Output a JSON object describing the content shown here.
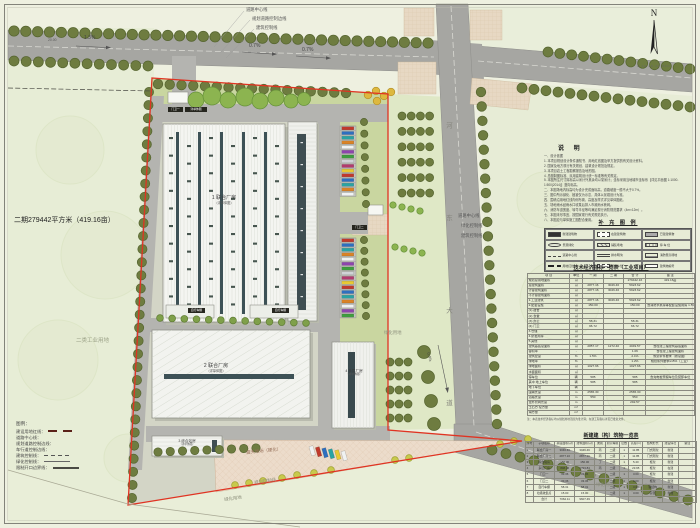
{
  "colors": {
    "paper": "#eef0e0",
    "road": "#a6a6a2",
    "inner_road": "#b4b4b0",
    "green_strip": "#c9d6a0",
    "outside_green": "#e7edd6",
    "tree": "#6e7c40",
    "bright_tree": "#8cb450",
    "boundary_red": "#e03322",
    "building_white": "#f4f5f1",
    "skylight_dark": "#3d5156",
    "plaza": "#ecdccb",
    "pad": "#e7d8c3"
  },
  "plan": {
    "boundary_area_label": "二期279442平方米（419.16亩）",
    "land_use_label": "二类工业用地",
    "top_line_labels": [
      "道路中心线",
      "规划道路控制边线",
      "建筑控制线"
    ],
    "right_line_labels": [
      "道路中心线",
      "绿化控制线",
      "建筑控制线"
    ],
    "slopes": {
      "s1": "1.3%",
      "s2": "0.7%",
      "s3": "0.7%",
      "s4": "0.4%"
    },
    "road_width_label": "20.00",
    "vertical_road_name": "河东大道",
    "buildings": [
      {
        "label": "1 联合厂房",
        "sub": "（详单体图）"
      },
      {
        "label": "2 联合厂房",
        "sub": "（详单体图）"
      },
      {
        "label": "3 综合站房",
        "sub": "（详单体图）"
      },
      {
        "label": "4 多层厂房",
        "sub": "（详单体图）"
      }
    ],
    "shed_label": "自行车棚",
    "gate1_label": "门卫一",
    "gate1_sub": "详单体图",
    "gate2_label": "门卫二",
    "plaza_label": "露天堆场（硬化）",
    "green_label": "绿化用地",
    "control_label": "规划控制线",
    "legend": {
      "title": "图例：",
      "items": [
        {
          "label": "建设用地红线：",
          "sample": "redash"
        },
        {
          "label": "道路中心线：",
          "sample": "none"
        },
        {
          "label": "规划道路控制边线：",
          "sample": "none"
        },
        {
          "label": "车行道控制边线：",
          "sample": "none"
        },
        {
          "label": "建筑控制线：",
          "sample": "dash"
        },
        {
          "label": "绿化控制线：",
          "sample": "solid"
        },
        {
          "label": "限制开口边界线：",
          "sample": "thick"
        }
      ]
    }
  },
  "panel": {
    "north": {
      "label": "N",
      "scale": "0  10  20  40  80m"
    },
    "notes": {
      "title": "说  明",
      "lines": [
        "一、设计依据",
        "1. 本项目规划设计条件通知书、用地红线图及甲方提供的有关设计资料。",
        "2. 国家及地方现行有关规划、建筑设计规范及规定。",
        "3. 本项目岩土工程勘察报告及地形图。",
        "4. 总图制图标准、民用建筑设计统一标准等有关规定。",
        "5. 本图所注尺寸除标高以米计外其余均以毫米计；坐标采用当地城市坐标系【详见平面图 1:1000-1:500(2014)】竖向标高。",
        "二、本图场地内标高均为设计完成面标高，道路坡度一般不大于0.7%。",
        "三、图中所示绿化、植被仅为示意，具体以景观设计为准。",
        "四、围墙沿用地红线内侧布置，高度及样式详见单体图纸。",
        "五、场地雨水经雨水口收集后排入市政雨水管网。",
        "六、消防车道宽度、转弯半径等均满足现行消防规范要求（4m×12m）。",
        "七、本图未尽事宜，按国家现行有关规范执行。",
        "八、本图应与单体施工图配合使用。"
      ]
    },
    "sup_legend": {
      "title": "补 充 图 例",
      "items": [
        {
          "sym": "solid",
          "label": "新建建筑物"
        },
        {
          "sym": "dash",
          "label": "在建建筑物"
        },
        {
          "sym": "gray",
          "label": "已建建筑物"
        },
        {
          "sym": "blob",
          "label": "景观绿化"
        },
        {
          "sym": "hatch",
          "label": "铺装场地"
        },
        {
          "sym": "vlines",
          "label": "停 车 位"
        },
        {
          "sym": "dashdot",
          "label": "道路中心线"
        },
        {
          "sym": "double",
          "label": "排水明沟"
        },
        {
          "sym": "ticks",
          "label": "消防登高场地"
        },
        {
          "sym": "bolddash",
          "label": "用地红线"
        },
        {
          "sym": "dash",
          "label": "机动车位"
        },
        {
          "sym": "open",
          "label": "建筑物编号"
        }
      ]
    },
    "table1": {
      "title": "技术经济指标一览表（工业项目）",
      "headers": [
        "项  目",
        "单位",
        "一 期",
        "二 期",
        "合  计",
        "备  注"
      ],
      "rows": [
        [
          "规划总用地面积",
          "㎡",
          "",
          "",
          "279442.16",
          "419.16亩"
        ],
        [
          "总建筑面积",
          "㎡",
          "2877.16",
          "3046.46",
          "5923.62",
          ""
        ],
        [
          "计容建筑面积",
          "㎡",
          "2877.16",
          "3046.46",
          "5923.62",
          ""
        ],
        [
          "不计容建筑面积",
          "㎡",
          "",
          "",
          "",
          ""
        ],
        [
          "1.工业建筑",
          "㎡",
          "2877.16",
          "3046.46",
          "5923.62",
          ""
        ],
        [
          "2.配套设施",
          "㎡",
          "150.00",
          "",
          "150.00",
          "含消防水泵房等配套设施用房 1.5%"
        ],
        [
          "(1) 宿舍",
          "㎡",
          "",
          "",
          "",
          ""
        ],
        [
          "(2) 食堂",
          "㎡",
          "",
          "",
          "",
          ""
        ],
        [
          "(3) 办公",
          "㎡",
          "58.31",
          "",
          "58.31",
          ""
        ],
        [
          "(4) 门卫",
          "㎡",
          "66.72",
          "",
          "66.72",
          ""
        ],
        [
          "3.仓储",
          "㎡",
          "",
          "",
          "",
          ""
        ],
        [
          "4.研发用房",
          "㎡",
          "",
          "",
          "",
          ""
        ],
        [
          "5.其他",
          "㎡",
          "",
          "",
          "",
          ""
        ],
        [
          "建筑基底总面积",
          "㎡",
          "2857.17",
          "1272.40",
          "4049.57",
          "含在建工程建筑基底面积"
        ],
        [
          "容积率",
          "-",
          "",
          "",
          "1.06",
          "含在建工程建筑面积"
        ],
        [
          "建筑密度",
          "%",
          "1.5%",
          "",
          "2.1%",
          "规划条件要求（按总图）"
        ],
        [
          "绿地率",
          "%",
          "",
          "",
          "1.2%",
          "规划条件要求≤15%（工业）"
        ],
        [
          "绿地面积",
          "㎡",
          "1027.66",
          "",
          "1027.66",
          ""
        ],
        [
          "水面面积",
          "㎡",
          "",
          "",
          "",
          ""
        ],
        [
          "停车位",
          "辆",
          "585",
          "",
          "585",
          "含充电桩预留车位及装卸车位"
        ],
        [
          "其中 地上车位",
          "辆",
          "585",
          "",
          "585",
          ""
        ],
        [
          "地下车位",
          "辆",
          "",
          "",
          "",
          ""
        ],
        [
          "围墙长度",
          "m",
          "2565.30",
          "",
          "2565.30",
          ""
        ],
        [
          "道路长度",
          "m",
          "550",
          "",
          "550",
          ""
        ],
        [
          "室外管网长度",
          "m",
          "",
          "",
          "292.57",
          ""
        ],
        [
          "土石方 挖方量",
          "m³",
          "",
          "",
          "",
          ""
        ],
        [
          "填方量",
          "m³",
          "",
          "",
          "",
          ""
        ]
      ],
      "footnote": "注：本表技术经济指标均以规划用地范围为准计算；在建工程指标详见已批复文件。"
    },
    "table2": {
      "title": "新建建（构）筑物一览表",
      "headers": [
        "序号",
        "子项名称",
        "基底面积(㎡)",
        "建筑面积(㎡)",
        "类别",
        "耐火等级",
        "层数",
        "高度(m)",
        "结构形式",
        "建设情况",
        "备注"
      ],
      "rows": [
        [
          "1",
          "联合厂房一",
          "3046.46",
          "3046.46",
          "丙",
          "二级",
          "1",
          "11.85",
          "门式刚架",
          "新建",
          ""
        ],
        [
          "2",
          "联合厂房二",
          "2877.16",
          "2877.16",
          "丙",
          "二级",
          "1",
          "11.85",
          "门式刚架",
          "新建",
          ""
        ],
        [
          "3",
          "综合站房",
          "150.00",
          "150.00",
          "丁",
          "二级",
          "1",
          "5.40",
          "框架",
          "新建",
          ""
        ],
        [
          "4",
          "多层厂房",
          "848.46",
          "3393.84",
          "丙",
          "二级",
          "4",
          "23.95",
          "框架",
          "在建",
          ""
        ],
        [
          "5",
          "门卫一",
          "33.36",
          "33.36",
          "",
          "二级",
          "1",
          "3.60",
          "框架",
          "新建",
          ""
        ],
        [
          "6",
          "门卫二",
          "33.36",
          "33.36",
          "",
          "二级",
          "1",
          "3.60",
          "框架",
          "新建",
          ""
        ],
        [
          "7",
          "自行车棚",
          "58.31",
          "58.31",
          "",
          "二级",
          "1",
          "3.00",
          "钢结构",
          "新建",
          ""
        ],
        [
          "8",
          "垃圾收集点",
          "15.00",
          "15.00",
          "",
          "二级",
          "1",
          "3.00",
          "砖混",
          "新建",
          ""
        ],
        [
          "",
          "合计",
          "7062.11",
          "9607.49",
          "",
          "",
          "",
          "",
          "",
          "",
          ""
        ]
      ]
    }
  }
}
